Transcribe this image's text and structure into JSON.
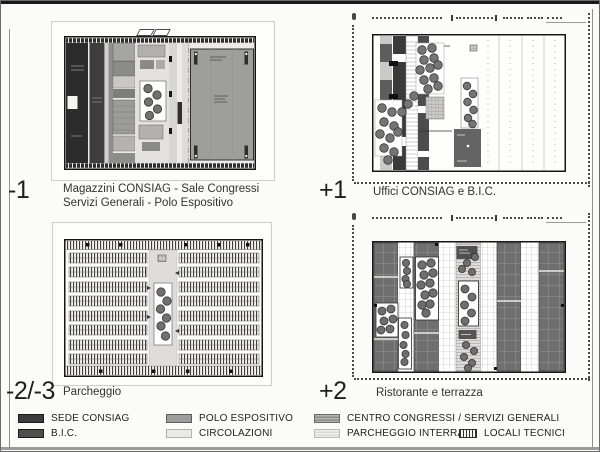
{
  "panels": [
    {
      "id": "minus-1",
      "level": "-1",
      "caption_line1": "Magazzini CONSIAG - Sale Congressi",
      "caption_line2": "Servizi Generali - Polo Espositivo"
    },
    {
      "id": "plus-1",
      "level": "+1",
      "caption_line1": "Uffici CONSIAG e B.I.C."
    },
    {
      "id": "minus-2-3",
      "level": "-2/-3",
      "caption_line1": "Parcheggio"
    },
    {
      "id": "plus-2",
      "level": "+2",
      "caption_line1": "Ristorante e terrazza"
    }
  ],
  "legend": {
    "items": [
      {
        "label": "SEDE CONSIAG",
        "color": "#3c3c3c",
        "pattern": "solid-dark"
      },
      {
        "label": "B.I.C.",
        "color": "#4e4e4e",
        "pattern": "solid-dark"
      },
      {
        "label": "POLO ESPOSITIVO",
        "color": "#9d9d9d",
        "pattern": "solid-gray"
      },
      {
        "label": "CIRCOLAZIONI",
        "color": "#eae9e6",
        "pattern": "solid-light"
      },
      {
        "label": "CENTRO CONGRESSI / SERVIZI GENERALI",
        "color": "#a8a8a6",
        "pattern": "striped-gray"
      },
      {
        "label": "PARCHEGGIO INTERRATO",
        "color": "#ececea",
        "pattern": "striped-light"
      },
      {
        "label": "LOCALI TECNICI",
        "color": "#ffffff",
        "pattern": "hatch-vertical"
      }
    ]
  }
}
